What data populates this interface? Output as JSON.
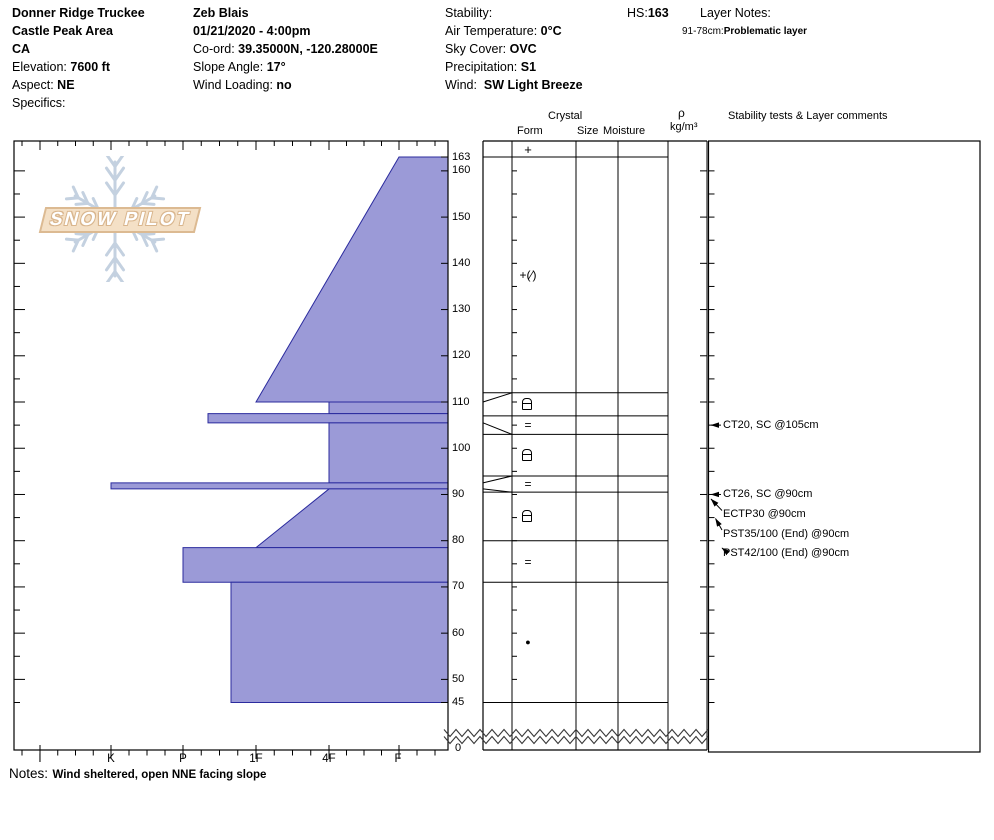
{
  "header": {
    "col1": {
      "location": "Donner Ridge Truckee",
      "area": "Castle Peak Area",
      "state": "CA",
      "elevation_label": "Elevation:",
      "elevation": "7600 ft",
      "aspect_label": "Aspect:",
      "aspect": "NE",
      "specifics_label": "Specifics:"
    },
    "col2": {
      "observer": "Zeb Blais",
      "datetime": "01/21/2020 - 4:00pm",
      "coord_label": "Co-ord:",
      "coord": "39.35000N, -120.28000E",
      "slope_label": "Slope Angle:",
      "slope": "17°",
      "wind_loading_label": "Wind Loading:",
      "wind_loading": "no"
    },
    "col3": {
      "stability_label": "Stability:",
      "air_temp_label": "Air Temperature:",
      "air_temp": "0°C",
      "sky_label": "Sky Cover:",
      "sky": "OVC",
      "precip_label": "Precipitation:",
      "precip": "S1",
      "wind_label": "Wind:",
      "wind": "SW Light Breeze"
    },
    "hs_label": "HS:",
    "hs": "163",
    "layer_notes_label": "Layer Notes:",
    "layer_note_range": "91-78cm:",
    "layer_note_text": "Problematic layer"
  },
  "columns": {
    "crystal": "Crystal",
    "form": "Form",
    "size": "Size",
    "moisture": "Moisture",
    "density_symbol": "ρ",
    "density_units": "kg/m³",
    "comments": "Stability tests & Layer comments"
  },
  "watermark": {
    "text": "SNOW PILOT"
  },
  "notes_label": "Notes:",
  "notes": "Wind sheltered, open NNE facing slope",
  "chart_data": {
    "type": "area",
    "title": "Snow hardness profile (hand hardness vs depth)",
    "hardness_labels": [
      "I",
      "K",
      "P",
      "1F",
      "4F",
      "F"
    ],
    "depth_labels": [
      163,
      160,
      150,
      140,
      130,
      120,
      110,
      100,
      90,
      80,
      70,
      60,
      50,
      45
    ],
    "ground_label": "0",
    "hs_cm": 163,
    "pit_bottom_cm": 45,
    "layers": [
      {
        "top": 163,
        "bottom": 110,
        "hardness_top": "F",
        "hardness_bottom": "1F"
      },
      {
        "top": 110,
        "bottom": 107.5,
        "hardness_top": "4F",
        "hardness_bottom": "4F"
      },
      {
        "top": 107.5,
        "bottom": 105.5,
        "hardness_top": "P-",
        "hardness_bottom": "P-"
      },
      {
        "top": 105.5,
        "bottom": 92.5,
        "hardness_top": "4F",
        "hardness_bottom": "4F"
      },
      {
        "top": 92.5,
        "bottom": 91.2,
        "hardness_top": "K",
        "hardness_bottom": "K"
      },
      {
        "top": 91.2,
        "bottom": 78.5,
        "hardness_top": "4F",
        "hardness_bottom": "1F"
      },
      {
        "top": 78.5,
        "bottom": 71,
        "hardness_top": "P",
        "hardness_bottom": "P"
      },
      {
        "top": 71,
        "bottom": 45,
        "hardness_top": "1F+",
        "hardness_bottom": "1F+"
      }
    ],
    "form_rows": [
      {
        "top": 166,
        "bottom": 163,
        "form": "+"
      },
      {
        "top": 163,
        "bottom": 112,
        "form": "+(∕)"
      },
      {
        "top": 112,
        "bottom": 107,
        "form": "⊟"
      },
      {
        "top": 107,
        "bottom": 103,
        "form": "="
      },
      {
        "top": 103,
        "bottom": 94,
        "form": "⊟"
      },
      {
        "top": 94,
        "bottom": 90.5,
        "form": "="
      },
      {
        "top": 90.5,
        "bottom": 80,
        "form": "⊟"
      },
      {
        "top": 80,
        "bottom": 71,
        "form": "="
      },
      {
        "top": 71,
        "bottom": 45,
        "form": "●"
      }
    ],
    "leaders": [
      {
        "from_depth": 110,
        "to_depth": 112
      },
      {
        "from_depth": 105.5,
        "to_depth": 103
      },
      {
        "from_depth": 92.5,
        "to_depth": 94
      },
      {
        "from_depth": 91.2,
        "to_depth": 90.5
      }
    ],
    "tests": [
      {
        "label": "CT20, SC @105cm",
        "depth": 105
      },
      {
        "label": "CT26, SC @90cm",
        "depth": 90
      },
      {
        "label": "ECTP30 @90cm",
        "depth": 90
      },
      {
        "label": "PST35/100 (End) @90cm",
        "depth": 90
      },
      {
        "label": "PST42/100 (End) @90cm",
        "depth": 90
      }
    ],
    "colors": {
      "layer_fill": "#9b9ad7",
      "layer_edge": "#2b2b9e",
      "axis": "#000000",
      "watermark_band": "#f4e0c6",
      "watermark_border": "#dcba92",
      "snowflake": "#c4d1e0"
    }
  }
}
